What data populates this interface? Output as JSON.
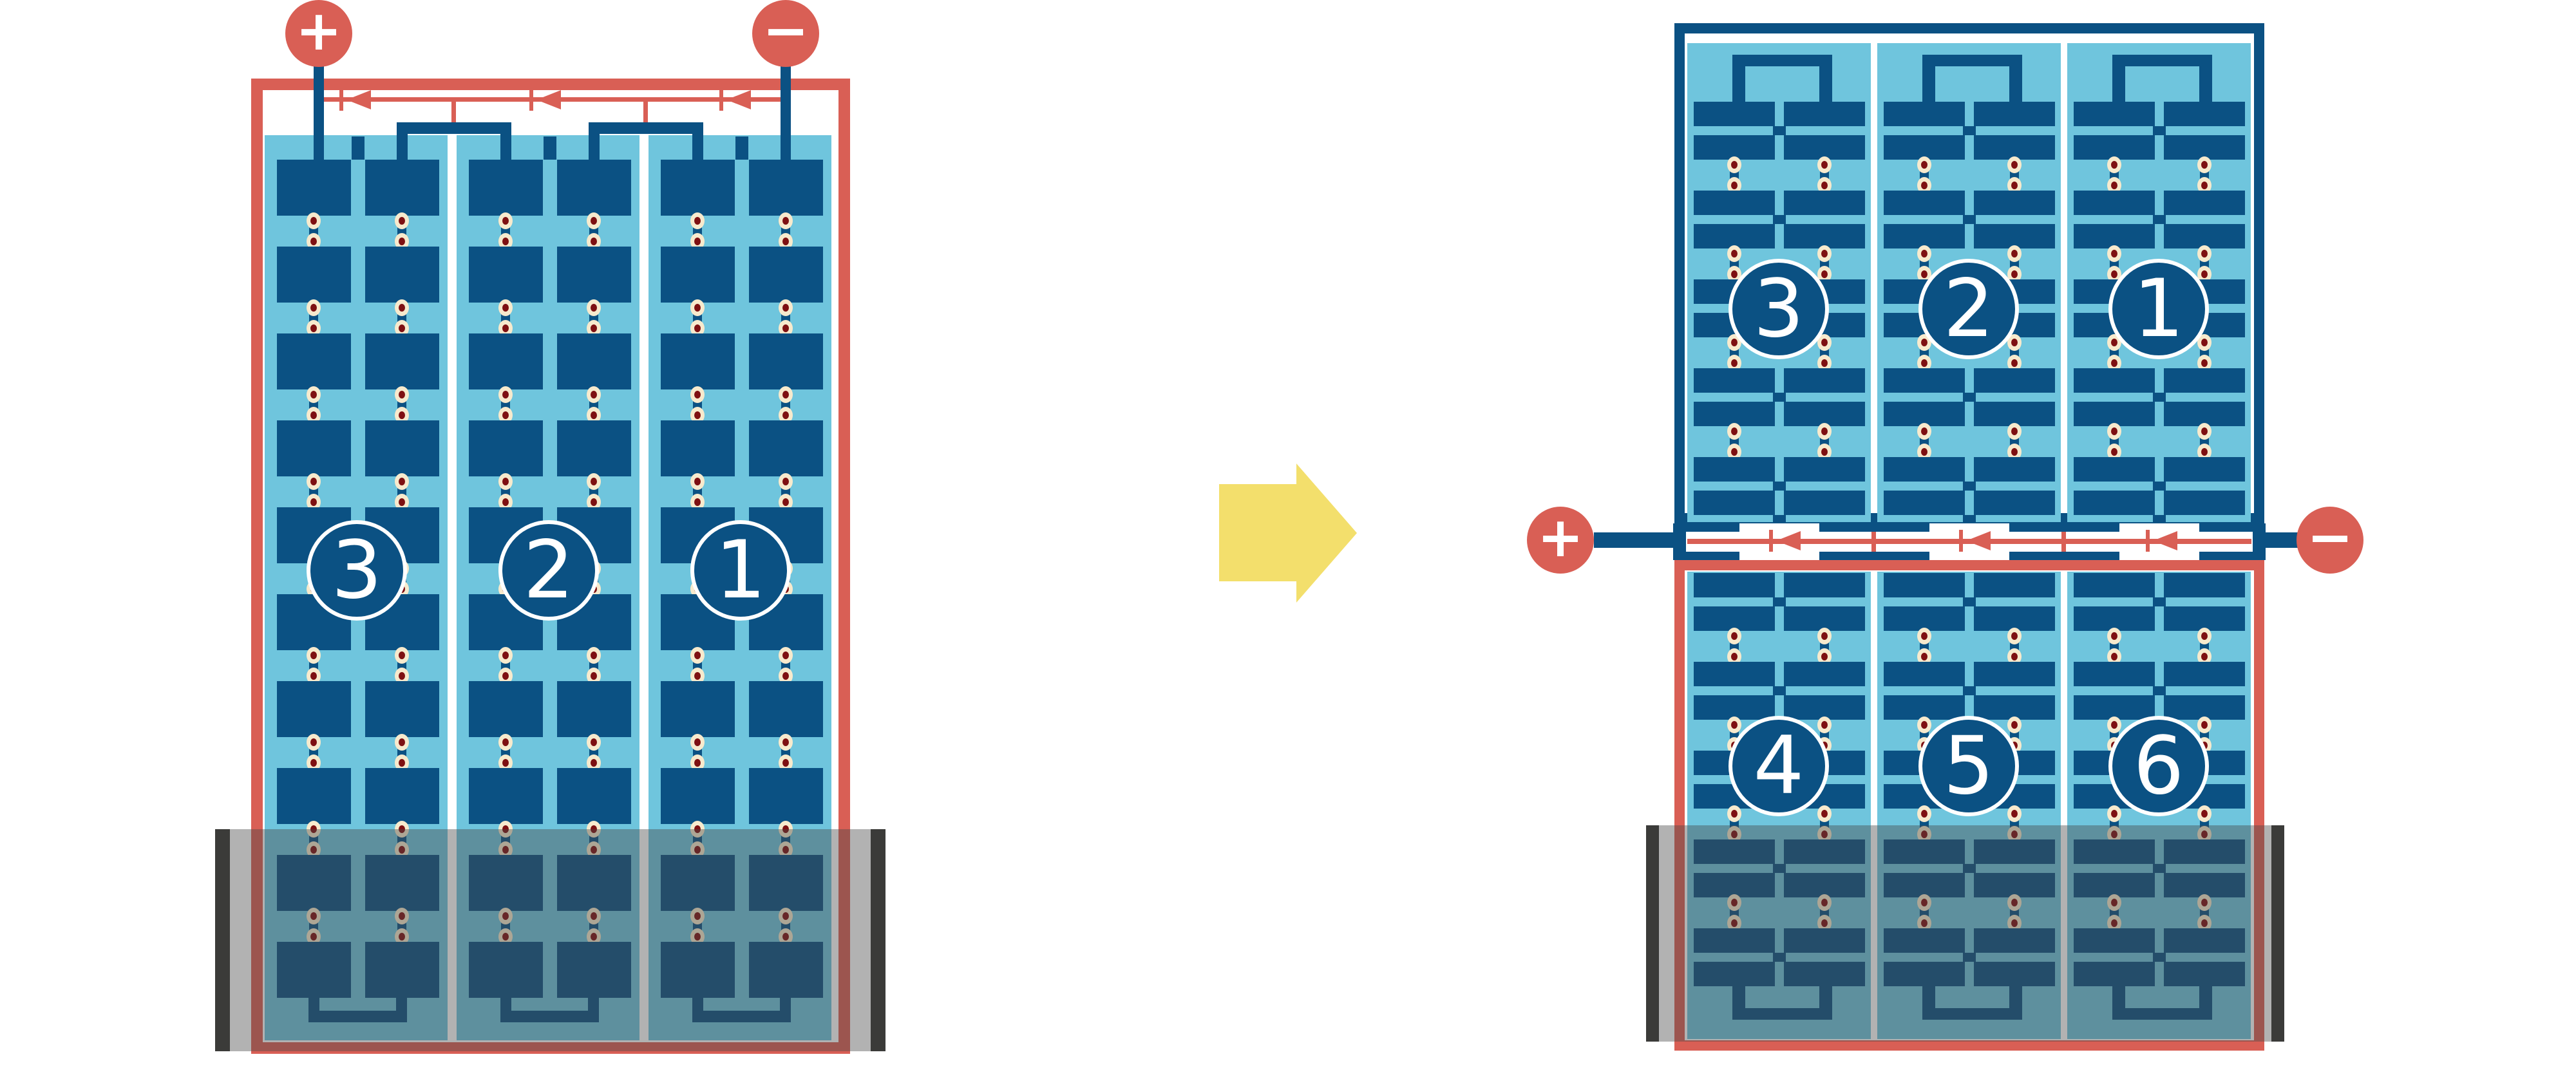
{
  "colors": {
    "red": "#D95F55",
    "dark_blue": "#0B5183",
    "light_blue": "#6FC5DD",
    "cream": "#F7EACD",
    "dot_red": "#7E1012",
    "arrow_yellow": "#F3DF6C",
    "shade_bar": "#3B3B39",
    "shade_overlay": "rgba(72,72,72,0.42)"
  },
  "left_module": {
    "positive_label": "+",
    "negative_label": "−",
    "string_labels": [
      "3",
      "2",
      "1"
    ]
  },
  "right_module": {
    "positive_label": "+",
    "negative_label": "−",
    "top_string_labels": [
      "3",
      "2",
      "1"
    ],
    "bottom_string_labels": [
      "4",
      "5",
      "6"
    ]
  }
}
